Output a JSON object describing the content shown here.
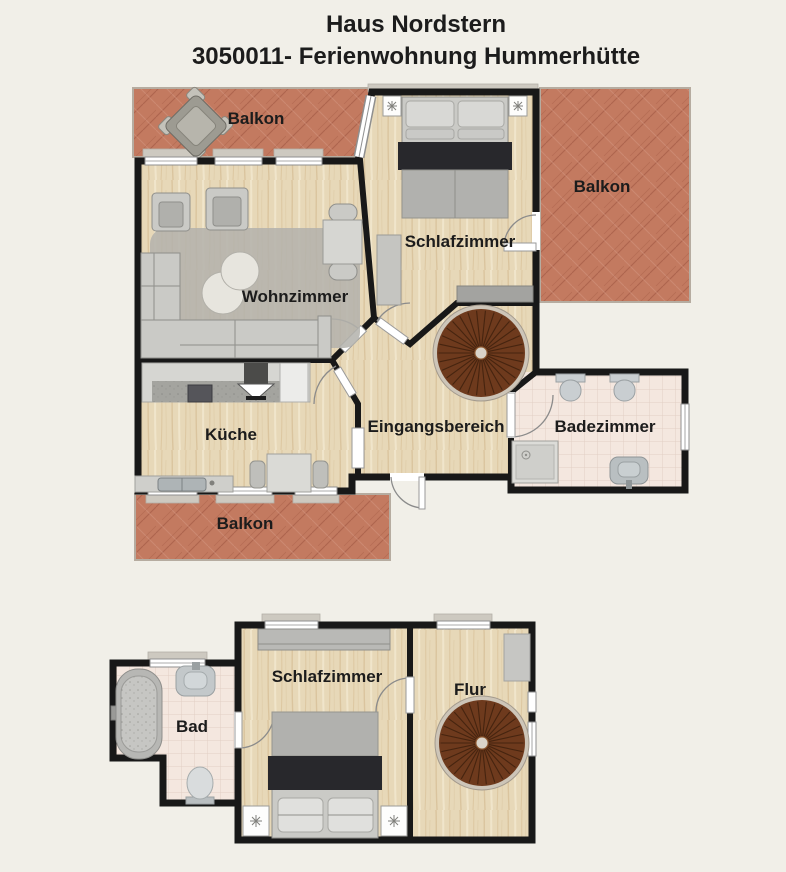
{
  "header": {
    "line1": "Haus Nordstern",
    "line2": "3050011- Ferienwohnung Hummerhütte"
  },
  "floors": {
    "upper": {
      "rooms": {
        "balkon_top": {
          "label": "Balkon"
        },
        "balkon_right": {
          "label": "Balkon"
        },
        "balkon_bottom": {
          "label": "Balkon"
        },
        "wohnzimmer": {
          "label": "Wohnzimmer"
        },
        "schlafzimmer": {
          "label": "Schlafzimmer"
        },
        "kueche": {
          "label": "Küche"
        },
        "eingangsbereich": {
          "label": "Eingangsbereich"
        },
        "badezimmer": {
          "label": "Badezimmer"
        }
      }
    },
    "lower": {
      "rooms": {
        "bad": {
          "label": "Bad"
        },
        "schlafzimmer": {
          "label": "Schlafzimmer"
        },
        "flur": {
          "label": "Flur"
        }
      }
    }
  },
  "colors": {
    "background": "#f1efe8",
    "wall": "#181818",
    "wood_floor": "#e7d8b8",
    "wood_grain": "#d0b488",
    "wood_light": "#f2e8cf",
    "brick": "#c37a60",
    "brick_dark": "#9c5340",
    "brick_light": "#d9a18c",
    "tile": "#f4e7df",
    "tile_line": "#e2cfc4",
    "furniture_light": "#cacac6",
    "furniture_mid": "#b0b0ac",
    "furniture_dark": "#8f8f8b",
    "bed_accent": "#28282c",
    "stair_wood": "#6e3a1d",
    "stair_line": "#46240f",
    "stair_rim": "#cdc5b8",
    "door_frame": "#8f8f8f",
    "window_fill": "#ffffff",
    "label": "#1c1c1c"
  }
}
